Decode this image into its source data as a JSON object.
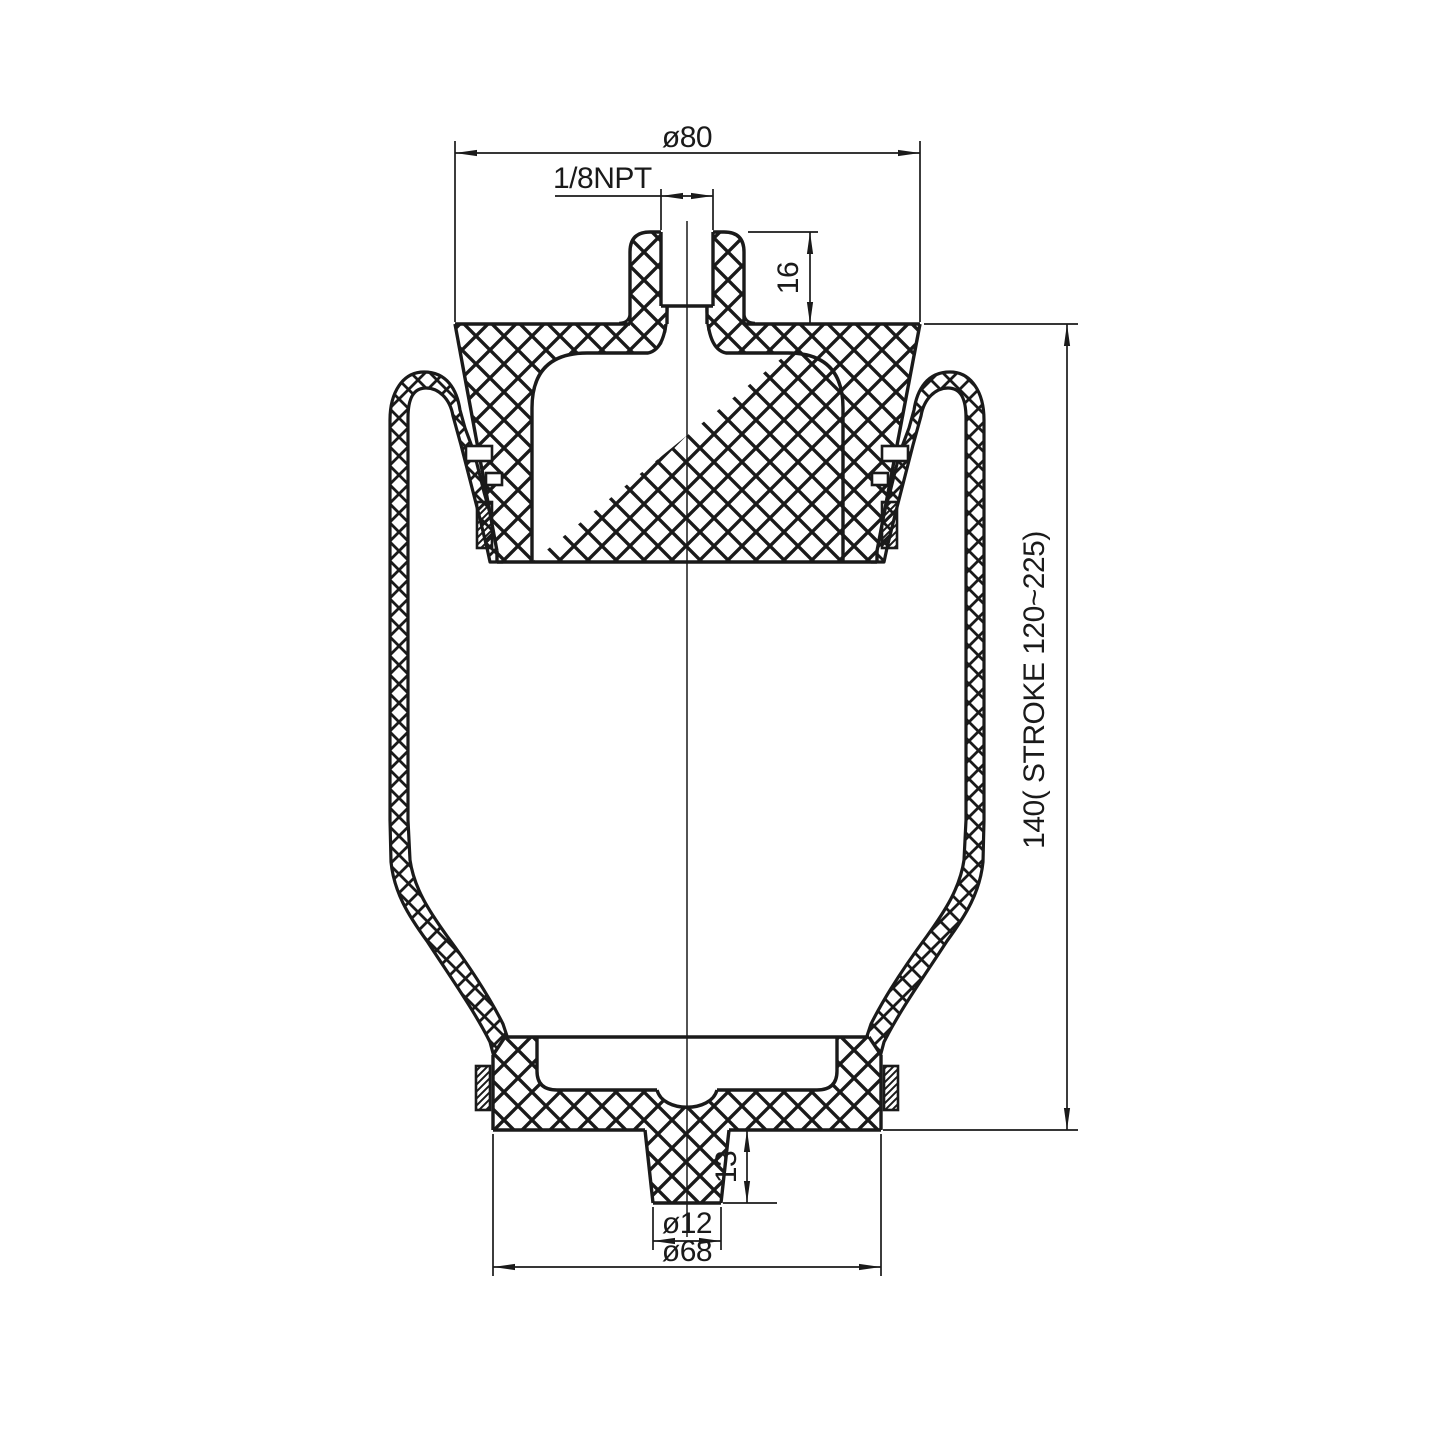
{
  "drawing": {
    "type": "technical-section-drawing",
    "subject": "rolling-lobe air spring / sleeve air bellows, sectional view",
    "dims": {
      "top_diameter": "ø80",
      "port_thread": "1/8NPT",
      "port_boss_height": "16",
      "overall_height_stroke": "140( STROKE 120~225)",
      "stud_height": "13",
      "stud_diameter": "ø12",
      "base_diameter": "ø68"
    },
    "colors": {
      "line": "#1a1a1a",
      "background": "#ffffff"
    }
  }
}
